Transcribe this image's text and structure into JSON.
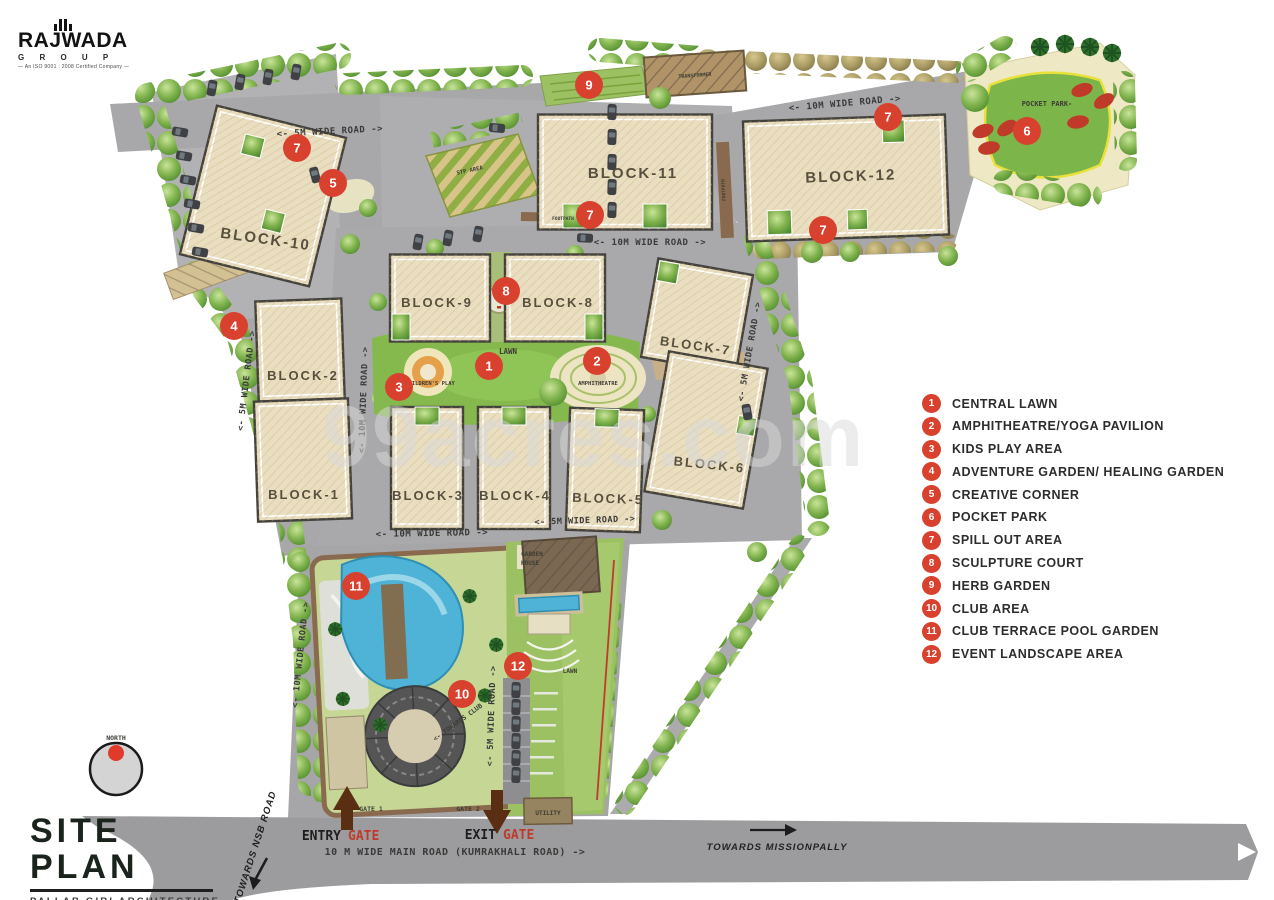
{
  "logo": {
    "name": "RAJWADA",
    "group": "G R O U P",
    "tagline": "— An ISO 9001 : 2008 Certified Company —"
  },
  "watermark": "99acres.com",
  "title": {
    "main": "SITE PLAN",
    "sub": "PALLAB GIRI ARCHITECTURE"
  },
  "compass": {
    "north": "NORTH"
  },
  "legend": {
    "items": [
      {
        "num": "1",
        "label": "CENTRAL LAWN"
      },
      {
        "num": "2",
        "label": "AMPHITHEATRE/YOGA PAVILION"
      },
      {
        "num": "3",
        "label": "KIDS PLAY AREA"
      },
      {
        "num": "4",
        "label": "ADVENTURE GARDEN/ HEALING GARDEN"
      },
      {
        "num": "5",
        "label": "CREATIVE CORNER"
      },
      {
        "num": "6",
        "label": "POCKET PARK"
      },
      {
        "num": "7",
        "label": "SPILL OUT AREA"
      },
      {
        "num": "8",
        "label": "SCULPTURE COURT"
      },
      {
        "num": "9",
        "label": "HERB GARDEN"
      },
      {
        "num": "10",
        "label": "CLUB AREA"
      },
      {
        "num": "11",
        "label": "CLUB TERRACE POOL GARDEN"
      },
      {
        "num": "12",
        "label": "EVENT LANDSCAPE AREA"
      }
    ]
  },
  "blocks": {
    "b1": "BLOCK-1",
    "b2": "BLOCK-2",
    "b3": "BLOCK-3",
    "b4": "BLOCK-4",
    "b5": "BLOCK-5",
    "b6": "BLOCK-6",
    "b7": "BLOCK-7",
    "b8": "BLOCK-8",
    "b9": "BLOCK-9",
    "b10": "BLOCK-10",
    "b11": "BLOCK-11",
    "b12": "BLOCK-12"
  },
  "plan": {
    "markers": [
      "1",
      "2",
      "3",
      "4",
      "5",
      "6",
      "7",
      "7",
      "7",
      "7",
      "8",
      "9",
      "10",
      "11",
      "12"
    ],
    "roads": {
      "five": "<- 5M WIDE ROAD ->",
      "ten": "<- 10M WIDE ROAD ->",
      "main": "10 M WIDE MAIN ROAD (KUMRAKHALI ROAD) ->",
      "towards_club": "<- TOWARDS CLUB",
      "footpath": "FOOTPATH"
    },
    "areas": {
      "lawn": "LAWN",
      "childrens_play": "CHILDREN'S PLAY",
      "amphitheatre": "AMPHITHEATRE",
      "pocket_park": "POCKET PARK-",
      "garden_house_1": "GARDEN",
      "garden_house_2": "HOUSE",
      "event_lawn": "LAWN",
      "utility": "UTILITY",
      "transformer": "TRANSFORMER",
      "stp": "STP AREA",
      "gate1": "GATE 1",
      "gate2": "GATE 2"
    },
    "gates": {
      "entry_word": "ENTRY",
      "exit_word": "EXIT",
      "gate_word": "GATE"
    },
    "directions": {
      "nsb": "TOWARDS NSB ROAD",
      "missionpally": "TOWARDS MISSIONPALLY"
    }
  },
  "colors": {
    "accent_red": "#d9412f",
    "road_gray": "#a8a8aa",
    "block_beige": "#eadec0",
    "lawn_green": "#85b94e",
    "pool_blue": "#4fb3d7",
    "gate_brown": "#5a2e12"
  }
}
